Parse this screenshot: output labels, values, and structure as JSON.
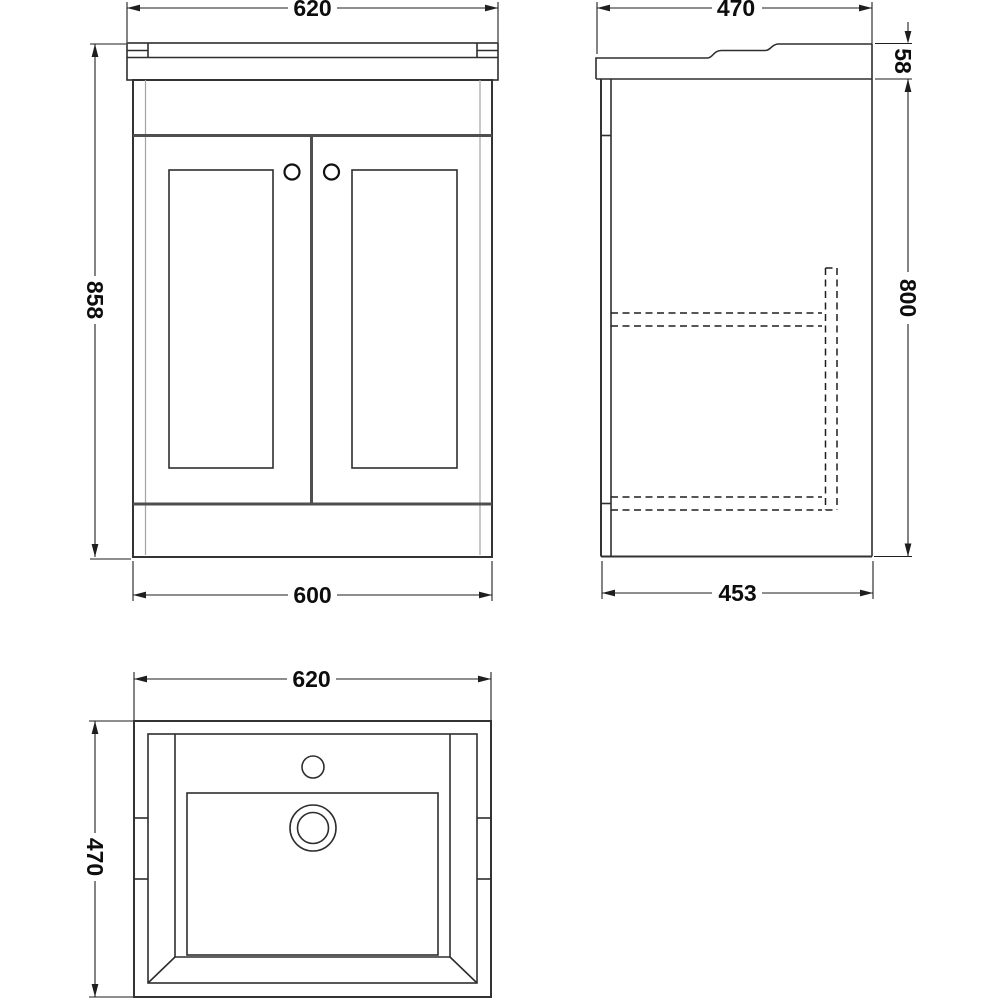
{
  "drawing": {
    "title": "vanity-unit-technical-drawing",
    "views": {
      "front": {
        "name": "front-view",
        "dims": {
          "width_top": "620",
          "height": "858",
          "width_bottom": "600"
        }
      },
      "side": {
        "name": "side-view",
        "dims": {
          "depth_top": "470",
          "counter_height": "58",
          "body_height": "800",
          "depth_bottom": "453"
        }
      },
      "plan": {
        "name": "plan-view",
        "dims": {
          "width": "620",
          "depth": "470"
        }
      }
    },
    "colors": {
      "background": "#ffffff",
      "line": "#2e2e2e",
      "heavy_line": "#4f4f4f",
      "light_line": "#a3a3a3",
      "dimension_line": "#1e1e1e",
      "label_text": "#0d0d0d"
    }
  }
}
